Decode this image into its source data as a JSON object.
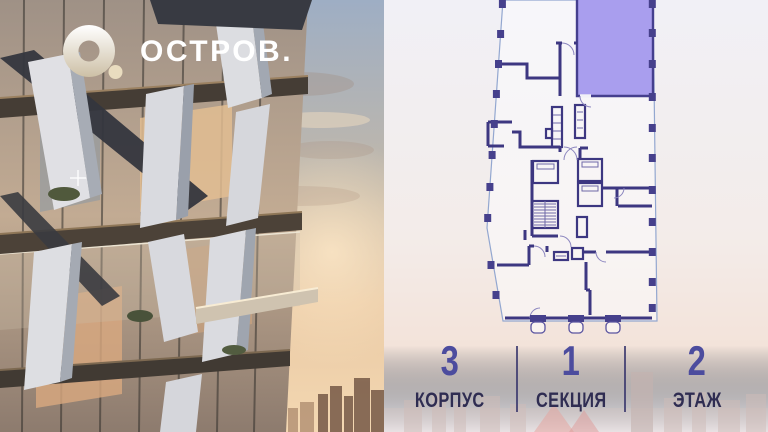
{
  "brand": {
    "name": "ОСТРОВ.",
    "icon": "torus-o-logo-icon"
  },
  "floor_plan": {
    "type": "building-floor-plan",
    "selected_unit_highlighted": true,
    "colors": {
      "highlight_fill": "#a99eee",
      "wall": "#3d3781",
      "boundary": "#93a7d0",
      "column": "#46408c"
    }
  },
  "stats": {
    "items": [
      {
        "value": "3",
        "label": "КОРПУС"
      },
      {
        "value": "1",
        "label": "СЕКЦИЯ"
      },
      {
        "value": "2",
        "label": "ЭТАЖ"
      }
    ],
    "value_color": "#4c4c9e",
    "label_color": "#2f2d52"
  }
}
